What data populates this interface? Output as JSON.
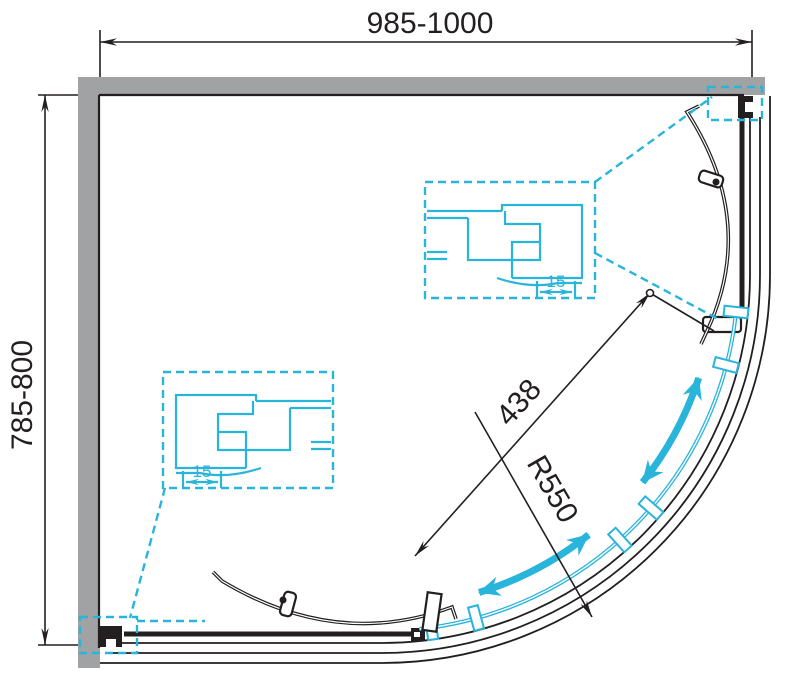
{
  "title": "Quadrant shower enclosure plan drawing",
  "dimensions": {
    "width": "985-1000",
    "depth": "785-800",
    "opening": "438",
    "radius": "R550",
    "detail_top_offset": "15",
    "detail_left_offset": "15"
  },
  "colors": {
    "wall_gray": "#a0a2a4",
    "line_black": "#231f20",
    "accent_cyan": "#29b4dc",
    "background": "#ffffff"
  }
}
